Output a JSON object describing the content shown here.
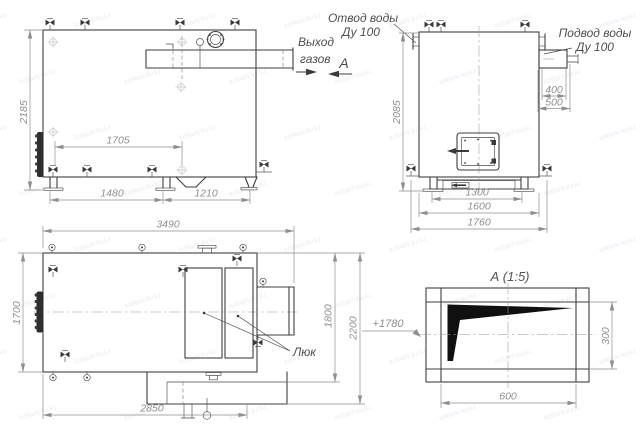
{
  "watermark": {
    "text": "kotlant-kv.kz"
  },
  "view_front": {
    "dim_height": "2185",
    "dim_inner_width": "1705",
    "dim_base_left": "1480",
    "dim_base_right": "1210",
    "gas_outlet_label_1": "Выход",
    "gas_outlet_label_2": "газов"
  },
  "view_side": {
    "dim_height": "2085",
    "dim_pipe_offset": "400",
    "dim_pipe_total": "500",
    "dim_base_inner": "1300",
    "dim_body_width": "1600",
    "dim_overall_width": "1760",
    "water_outlet_label_1": "Отвод воды",
    "water_outlet_label_2": "Ду 100",
    "water_inlet_label_1": "Подвод воды",
    "water_inlet_label_2": "Ду 100",
    "section_letter": "А"
  },
  "view_top": {
    "dim_overall_length": "3490",
    "dim_width": "1700",
    "dim_body_length": "2850",
    "dim_depth_inner": "1800",
    "dim_depth_overall": "2200",
    "hatch_label": "Люк",
    "level_mark": "+1780"
  },
  "view_detail": {
    "title": "А (1:5)",
    "dim_width": "600",
    "dim_height": "300"
  }
}
